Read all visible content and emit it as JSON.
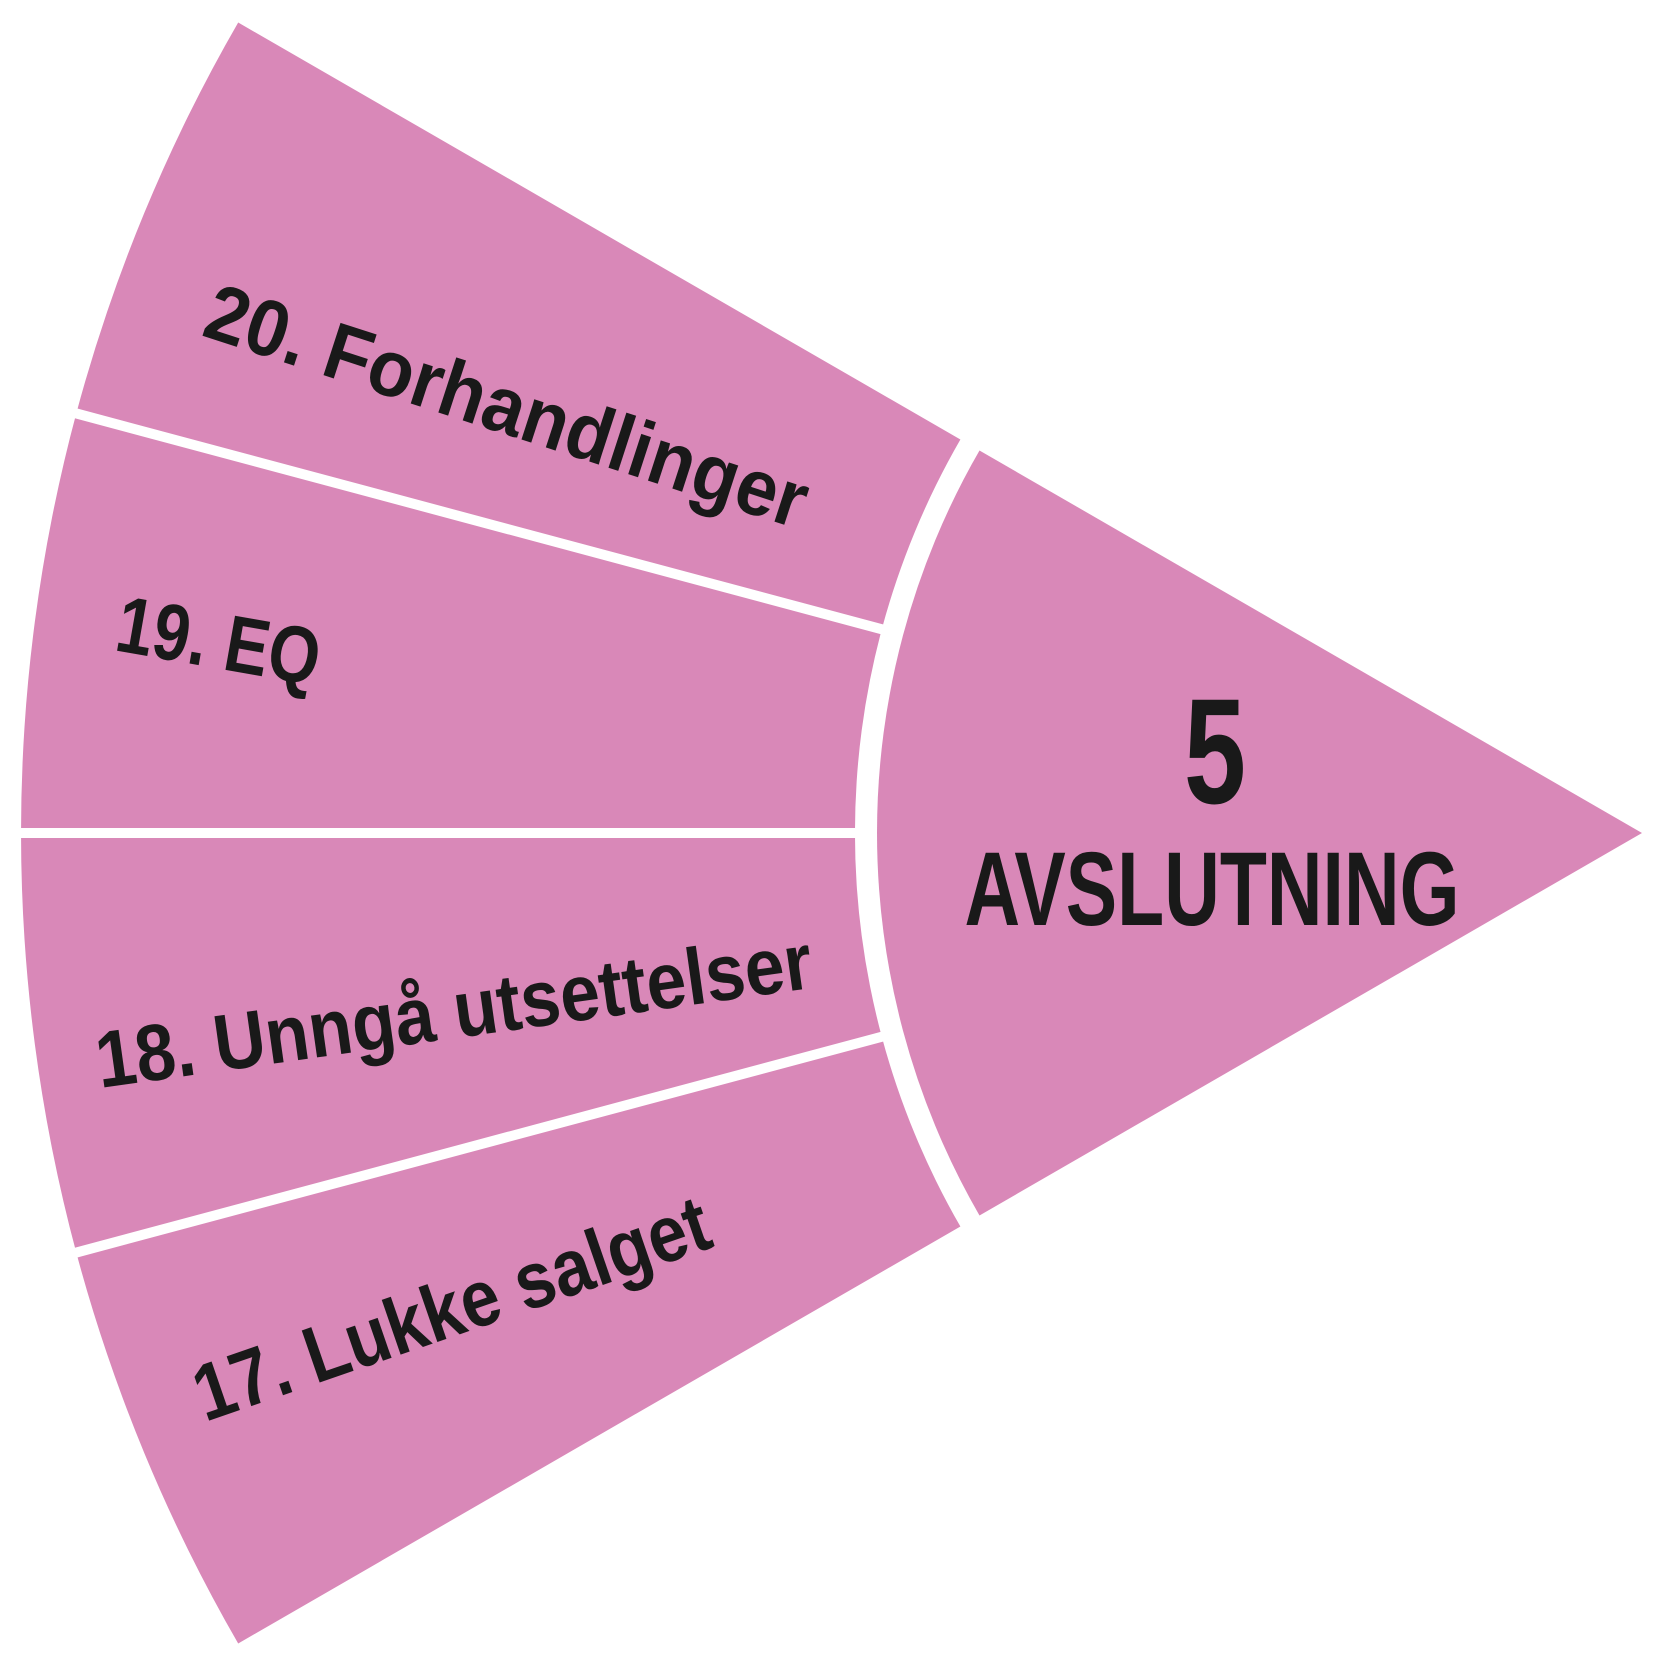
{
  "diagram": {
    "phase_number": "5",
    "phase_title": "AVSLUTNING",
    "segments": [
      {
        "label": "20. Forhandlinger"
      },
      {
        "label": "19. EQ"
      },
      {
        "label": "18. Unngå utsettelser"
      },
      {
        "label": "17. Lukke salget"
      }
    ],
    "colors": {
      "fill": "#D988B8",
      "text": "#191919",
      "separator": "#FFFFFF",
      "background": "#FFFFFF"
    }
  }
}
